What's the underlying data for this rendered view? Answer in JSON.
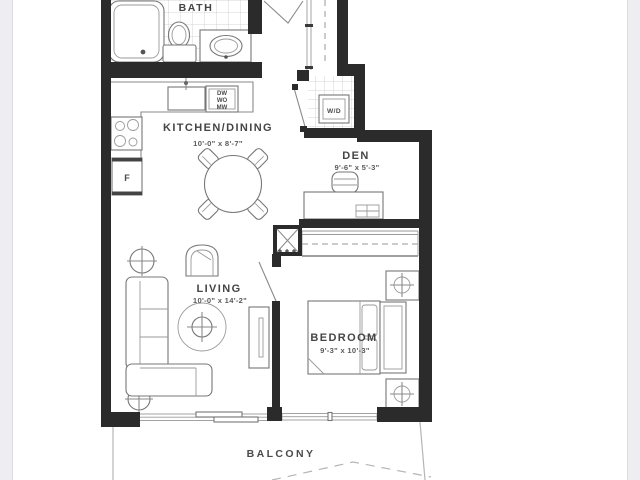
{
  "rooms": {
    "bath": {
      "label": "BATH"
    },
    "kitchen": {
      "label": "KITCHEN/DINING",
      "dims": "10'-0\" x 8'-7\""
    },
    "den": {
      "label": "DEN",
      "dims": "9'-6\" x 5'-3\""
    },
    "living": {
      "label": "LIVING",
      "dims": "10'-0\" x 14'-2\""
    },
    "bedroom": {
      "label": "BEDROOM",
      "dims": "9'-3\" x 10'-3\""
    },
    "balcony": {
      "label": "BALCONY"
    }
  },
  "appliances": {
    "washer_dryer": "W/D",
    "fridge": "F",
    "stack": [
      "DW",
      "WO",
      "MW"
    ]
  },
  "colors": {
    "wall": "#2b2b2b",
    "furniture_line": "#8a8a8a",
    "background": "#ffffff",
    "margin": "#ededf2"
  }
}
